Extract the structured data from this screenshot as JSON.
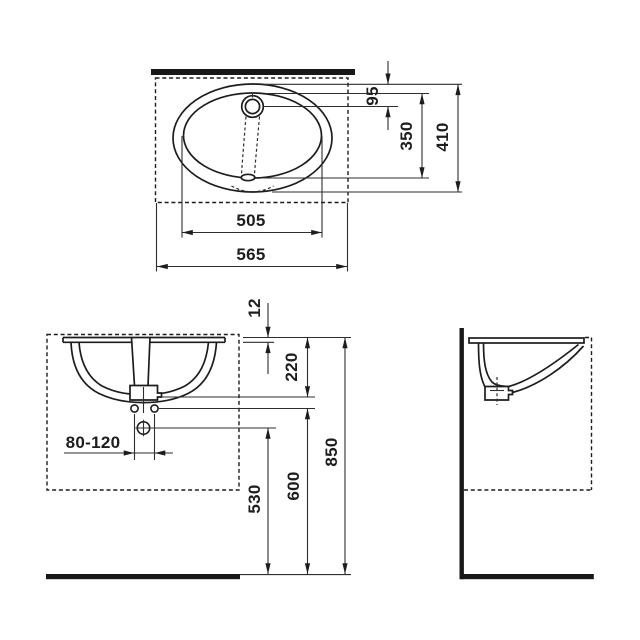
{
  "drawing": {
    "subject": "oval under-counter washbasin dimensional drawing",
    "background_color": "#ffffff",
    "line_color": "#1d1d1b"
  },
  "views": {
    "top": {
      "name": "top view",
      "dims": [
        {
          "label": "95"
        },
        {
          "label": "350"
        },
        {
          "label": "410"
        },
        {
          "label": "505"
        },
        {
          "label": "565"
        }
      ]
    },
    "front": {
      "name": "front view",
      "dims": [
        {
          "label": "12"
        },
        {
          "label": "220"
        },
        {
          "label": "80-120"
        },
        {
          "label": "530"
        },
        {
          "label": "600"
        },
        {
          "label": "850"
        }
      ]
    },
    "side": {
      "name": "side view",
      "dims": []
    }
  }
}
